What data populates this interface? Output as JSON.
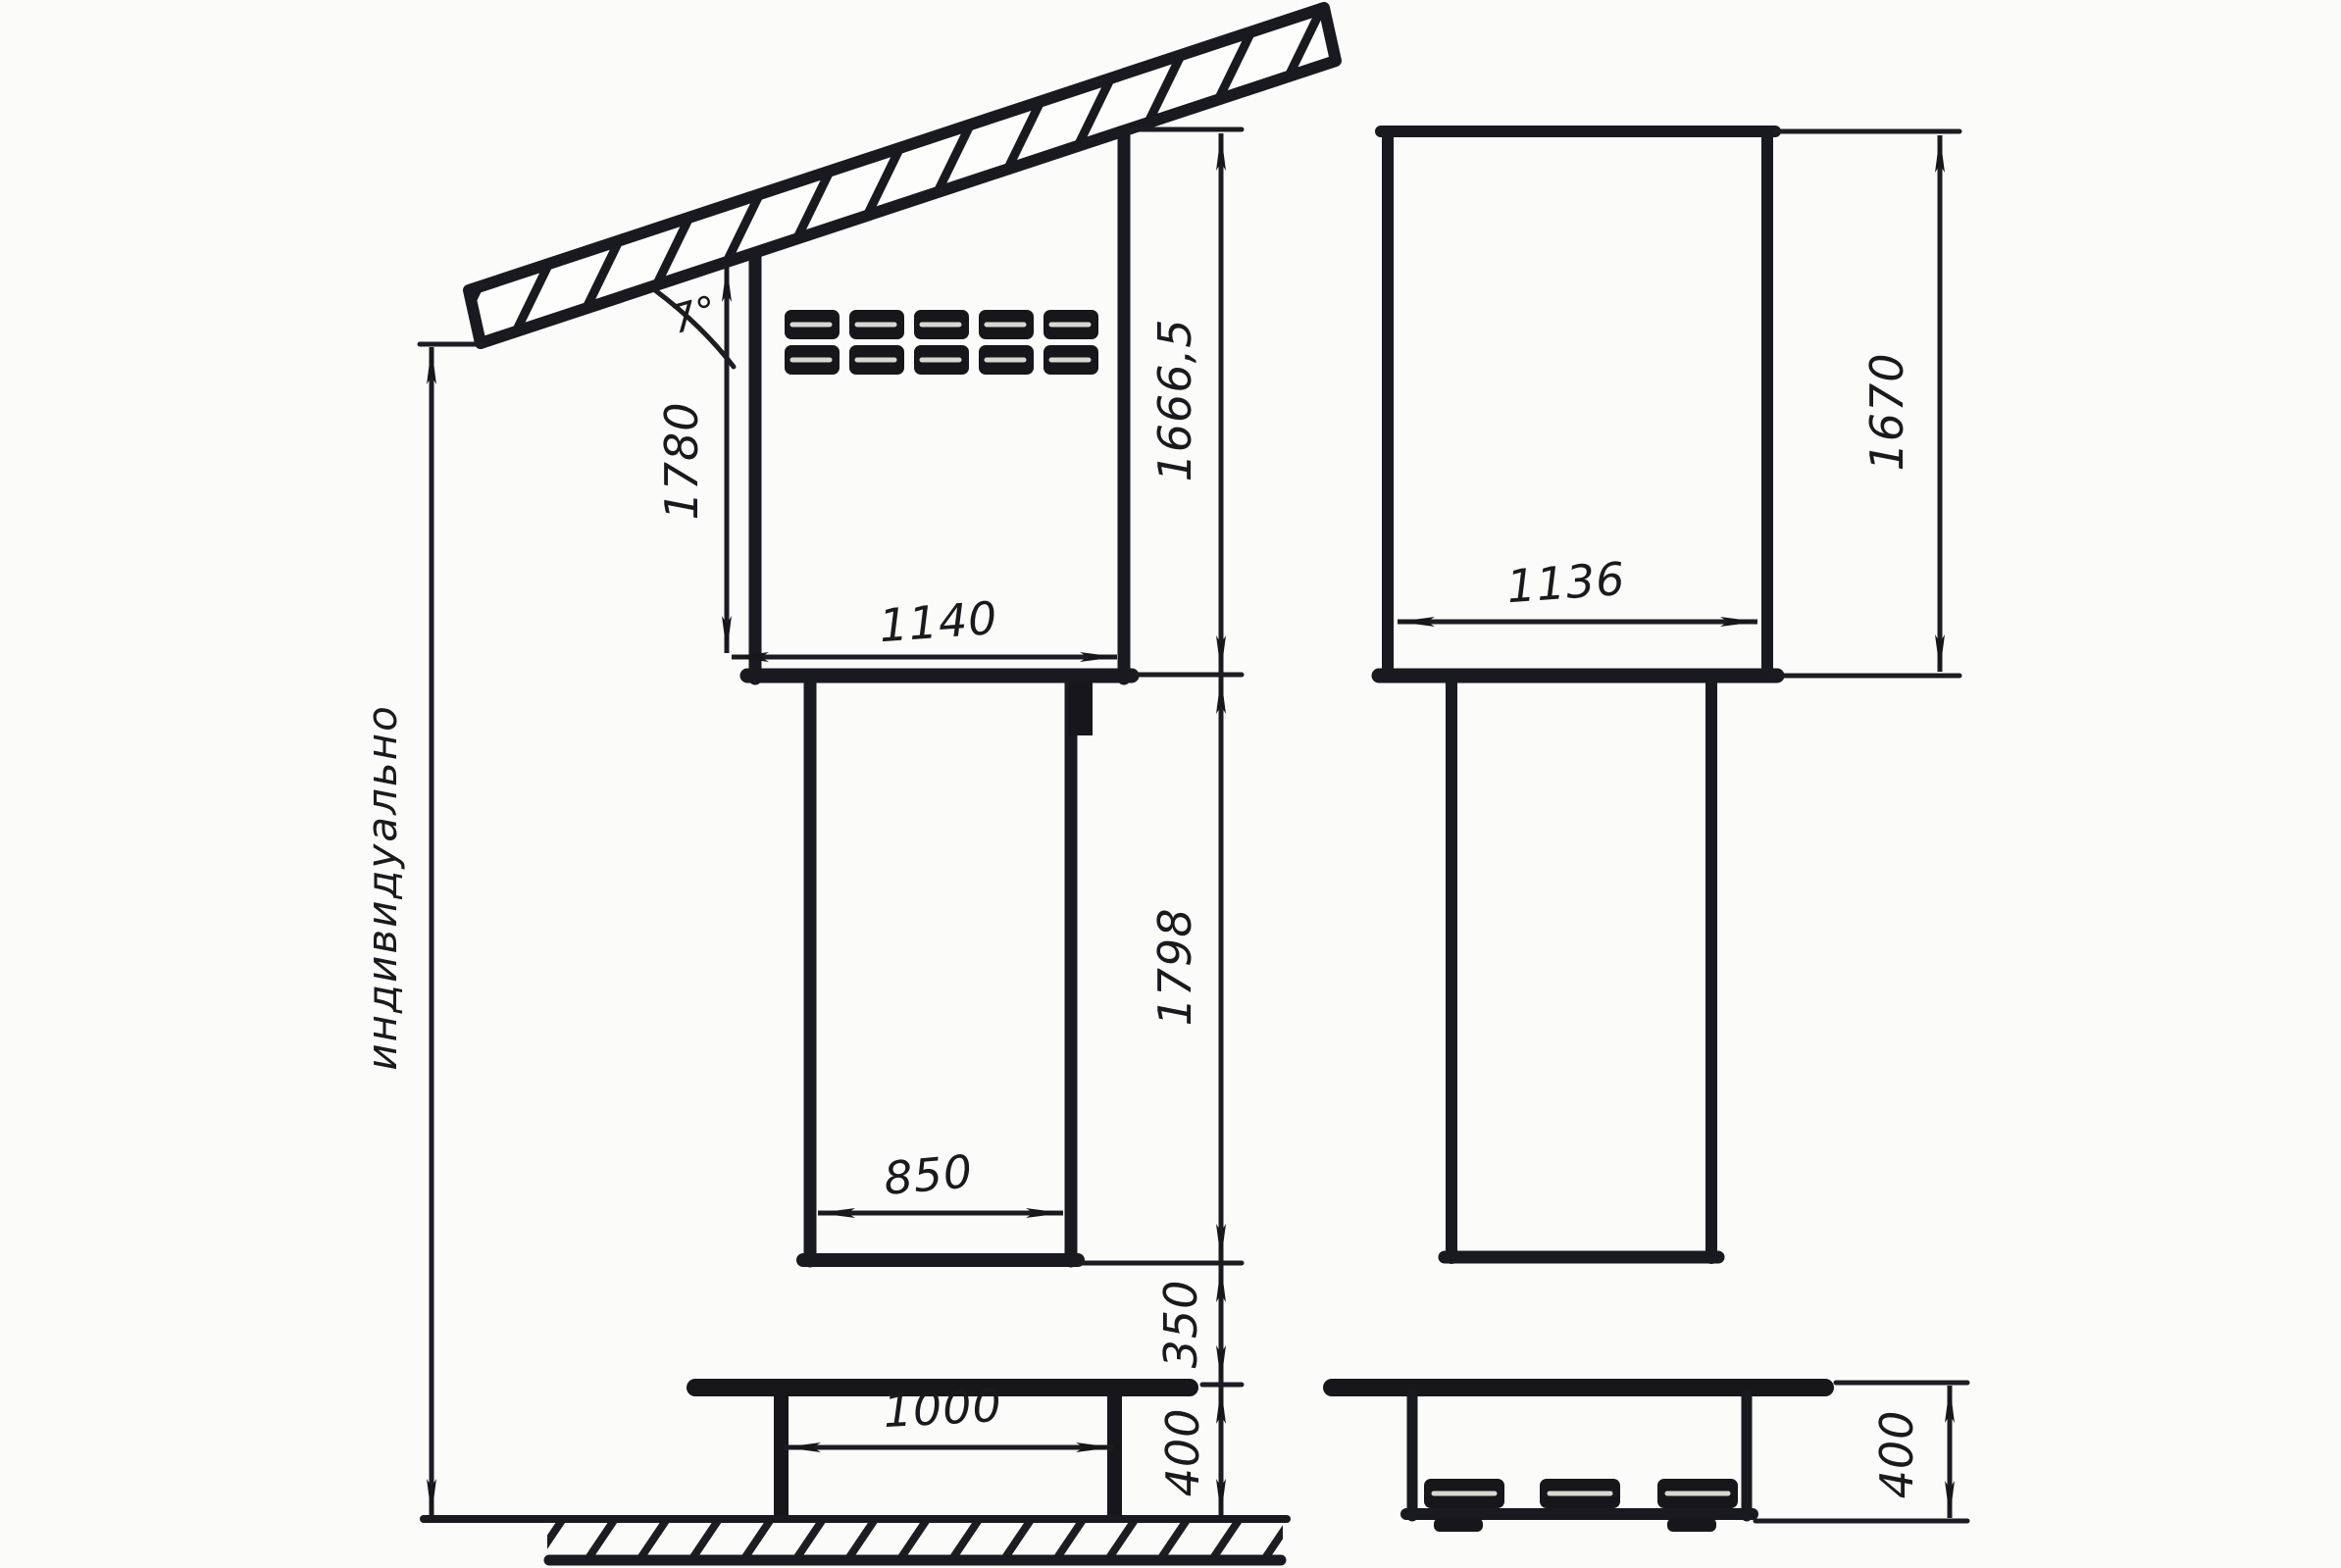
{
  "page": {
    "background": "#fbfbf9",
    "ink": "#1a1a1e",
    "kind": "hand-drawn technical drawing, two orthographic views of a roadside kiosk/payment-terminal cabinet on a pedestal under a slanted canopy"
  },
  "drawing": {
    "left_view": {
      "roof_angle": "7°",
      "front_wall_height": "1780",
      "cabinet_height": "1666,5",
      "cabinet_width": "1140",
      "column_height": "1798",
      "column_width": "850",
      "clearance_below_column": "350",
      "stand_height": "400",
      "stand_leg_spacing": "1000",
      "overall_height": "индивидуально"
    },
    "right_view": {
      "cabinet_width": "1136",
      "cabinet_height": "1670",
      "stand_height": "400"
    }
  }
}
